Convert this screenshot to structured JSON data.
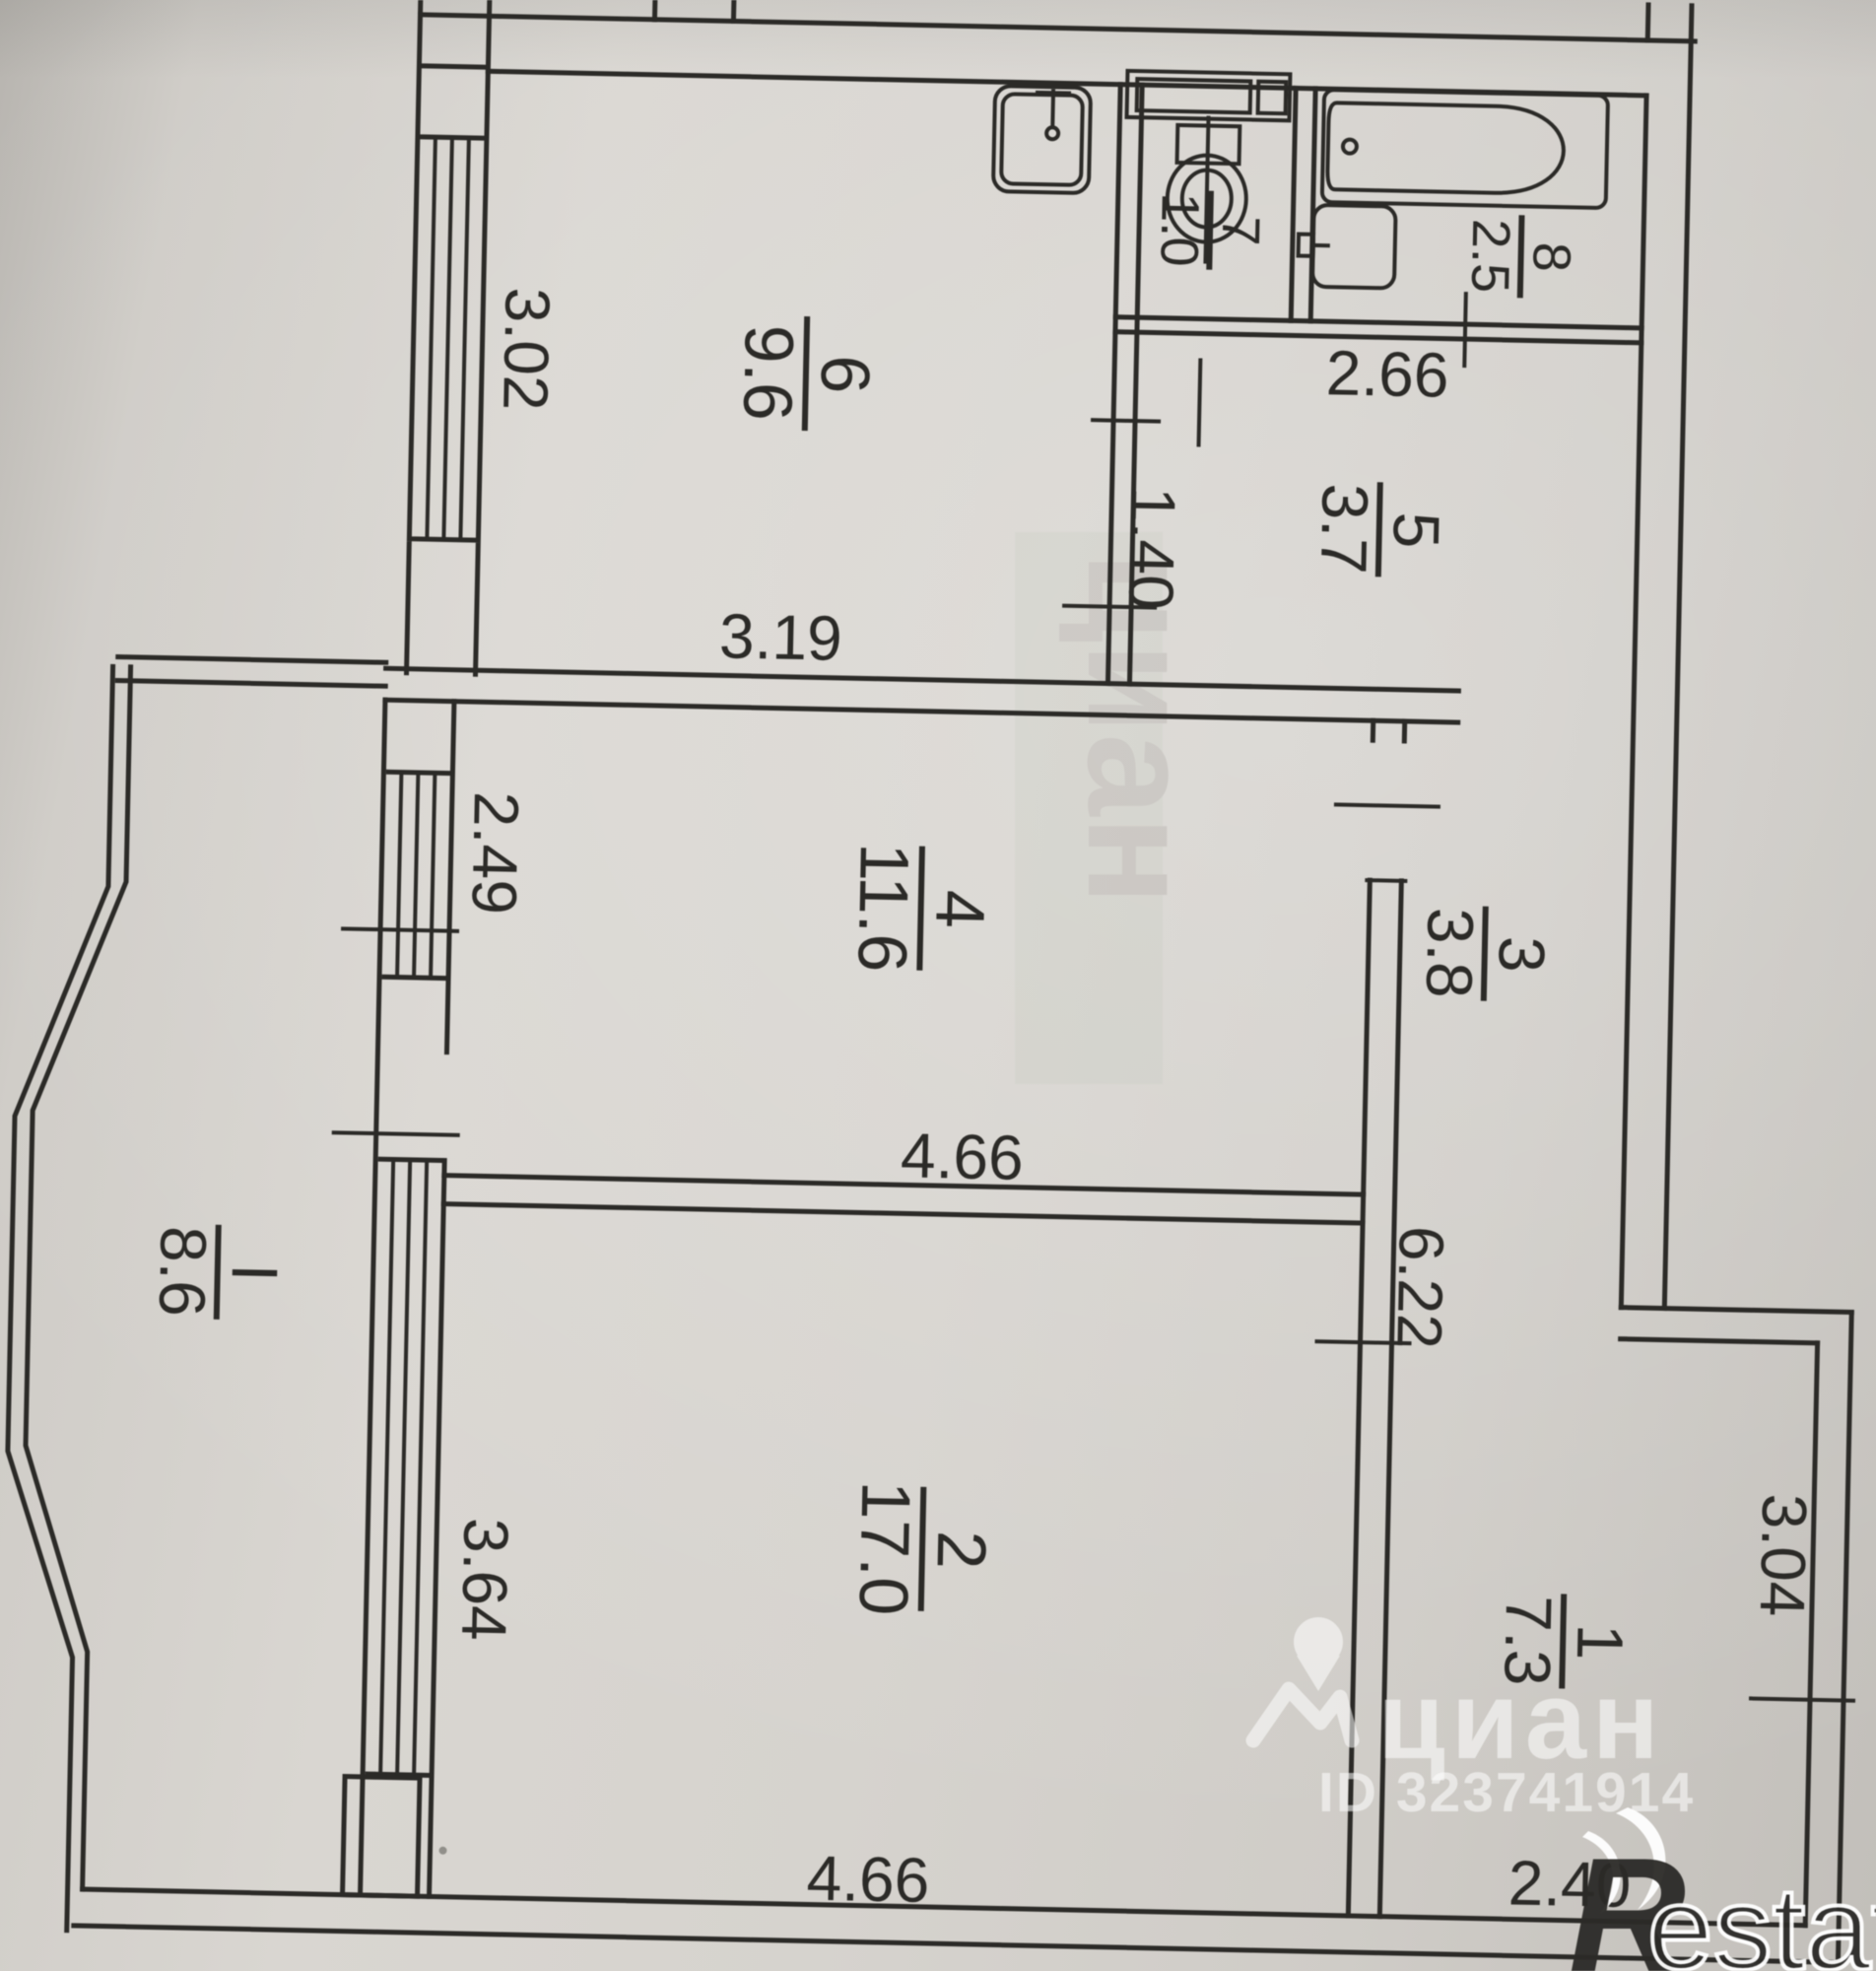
{
  "document_type": "apartment floor plan photo",
  "rooms": [
    {
      "number": "6",
      "area": "9.6"
    },
    {
      "number": "7",
      "area": "1.0"
    },
    {
      "number": "8",
      "area": "2.5"
    },
    {
      "number": "5",
      "area": "3.7"
    },
    {
      "number": "4",
      "area": "11.6"
    },
    {
      "number": "3",
      "area": "3.8"
    },
    {
      "number": "2",
      "area": "17.0"
    },
    {
      "number": "1",
      "area": "7.3"
    },
    {
      "number": "I",
      "area": "8.6"
    }
  ],
  "dimensions": {
    "kitchen_window": "3.02",
    "kitchen_width": "3.19",
    "hall_by_wc": "1.40",
    "sanitary_width": "2.66",
    "room4_depth": "2.49",
    "room4_width": "4.66",
    "long_wall": "6.22",
    "room2_depth": "3.64",
    "room2_width": "4.66",
    "room1_depth": "3.04",
    "room1_width": "2.40"
  },
  "fixtures": [
    "kitchen-sink",
    "ventilation-shaft",
    "toilet",
    "bathtub",
    "washbasin"
  ],
  "watermarks": {
    "cian_logo_text": "циан",
    "listing_id": "ID 323741914",
    "restate_r": "R",
    "restate_suffix": "estate",
    "faint_text": "циан"
  },
  "colors": {
    "ink": "#2b2a27",
    "paper": "#d5d2cd",
    "watermark": "#ffffff"
  }
}
